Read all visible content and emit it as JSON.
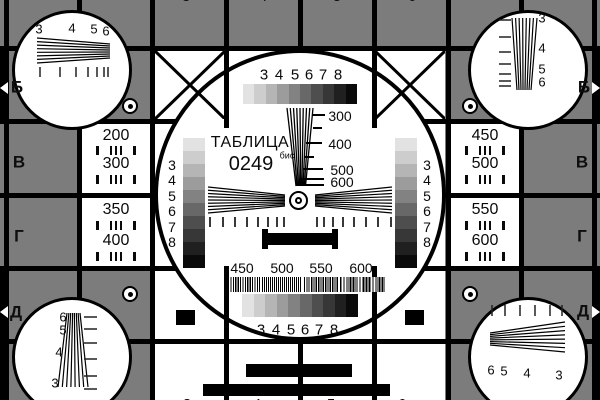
{
  "colors": {
    "background": "#7c7c7c",
    "line": "#000000",
    "panel": "#ffffff",
    "letter": "#0e0e0e"
  },
  "title": {
    "name": "ТАБЛИЦА",
    "code": "0249",
    "code_suffix": "бис"
  },
  "grayscale": {
    "steps": [
      "#e2e2e2",
      "#cdcdcd",
      "#b5b5b5",
      "#9c9c9c",
      "#828282",
      "#686868",
      "#4e4e4e",
      "#373737",
      "#202020",
      "#0a0a0a"
    ],
    "labels": [
      "3",
      "4",
      "5",
      "6",
      "7",
      "8"
    ]
  },
  "center": {
    "vertical_wedge_labels": [
      "300",
      "400",
      "500",
      "600"
    ],
    "burst_labels": [
      "450",
      "500",
      "550",
      "600"
    ]
  },
  "side_panels": {
    "left_top": {
      "rows": [
        "200",
        "300"
      ]
    },
    "left_bottom": {
      "rows": [
        "350",
        "400"
      ]
    },
    "right_top": {
      "rows": [
        "450",
        "500"
      ]
    },
    "right_bottom": {
      "rows": [
        "550",
        "600"
      ]
    }
  },
  "row_letters": {
    "b": "Б",
    "v": "В",
    "g": "Г",
    "d": "Д"
  },
  "corner_wedges": {
    "top_left": [
      "3",
      "4",
      "5",
      "6"
    ],
    "top_right": [
      "3",
      "4",
      "5",
      "6"
    ],
    "bottom_left": [
      "6",
      "5",
      "4",
      "3"
    ],
    "bottom_right": [
      "6",
      "5",
      "4",
      "3"
    ]
  },
  "edge_digits": {
    "top": [
      "3",
      "4",
      "5",
      "6"
    ],
    "bottom": [
      "3",
      "4",
      "5",
      "6"
    ]
  }
}
